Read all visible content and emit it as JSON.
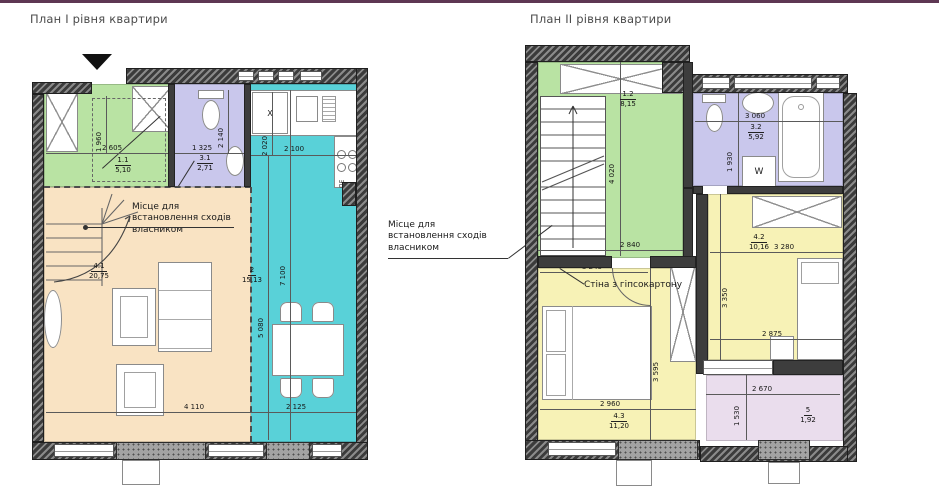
{
  "meta": {
    "type": "apartment-two-level-floor-plan",
    "language": "uk"
  },
  "titles": {
    "plan1": "План I рівня квартири",
    "plan2": "План II рівня квартири"
  },
  "annotations": {
    "stairs_note_plan1": "Місце для встановлення сходів власником",
    "stairs_note_plan2": "Місце для встановлення сходів власником",
    "drywall_note": "Стіна з гіпсокартону"
  },
  "markers": {
    "fridge": "X",
    "washer": "W",
    "stove": "ПЕ"
  },
  "colors": {
    "wall_dark": "#3b3b3b",
    "hall_green": "#b9e3a3",
    "bath_lavender": "#c9c7ec",
    "kitchen_cyan": "#59d1d8",
    "living_beige": "#f9e3c3",
    "bedroom_yellow": "#f7f2b6",
    "balcony_pink": "#eadded",
    "header_line": "#5e3753"
  },
  "plan1": {
    "rooms": [
      {
        "id": "1.1",
        "area": "5,10"
      },
      {
        "id": "2",
        "area": "15,13"
      },
      {
        "id": "3.1",
        "area": "2,71"
      },
      {
        "id": "4.1",
        "area": "20,75"
      }
    ],
    "dims": {
      "hall_w": "2 605",
      "hall_h": "1 960",
      "bath_w": "1 325",
      "bath_h": "2 140",
      "kitchen_col_h": "2 020",
      "kitchen_w": "2 100",
      "kitchen_h_full": "7 100",
      "kitchen_h": "5 080",
      "living_w": "4 110",
      "kitchen_w_bottom": "2 125"
    }
  },
  "plan2": {
    "rooms": [
      {
        "id": "1.2",
        "area": "8,15"
      },
      {
        "id": "3.2",
        "area": "5,92"
      },
      {
        "id": "4.2",
        "area": "10,16"
      },
      {
        "id": "4.3",
        "area": "11,20"
      },
      {
        "id": "5",
        "area": "1,92"
      }
    ],
    "dims": {
      "hall_h": "4 020",
      "hall_w": "2 840",
      "bath_w": "3 060",
      "bath_h": "1 930",
      "bed43_top_w": "3 245",
      "bed42_w": "3 280",
      "bed42_h": "3 350",
      "bed42_bottom_w": "2 875",
      "bed43_h": "3 595",
      "bed43_w": "2 960",
      "balcony_h": "1 530",
      "balcony_w": "2 670"
    }
  }
}
